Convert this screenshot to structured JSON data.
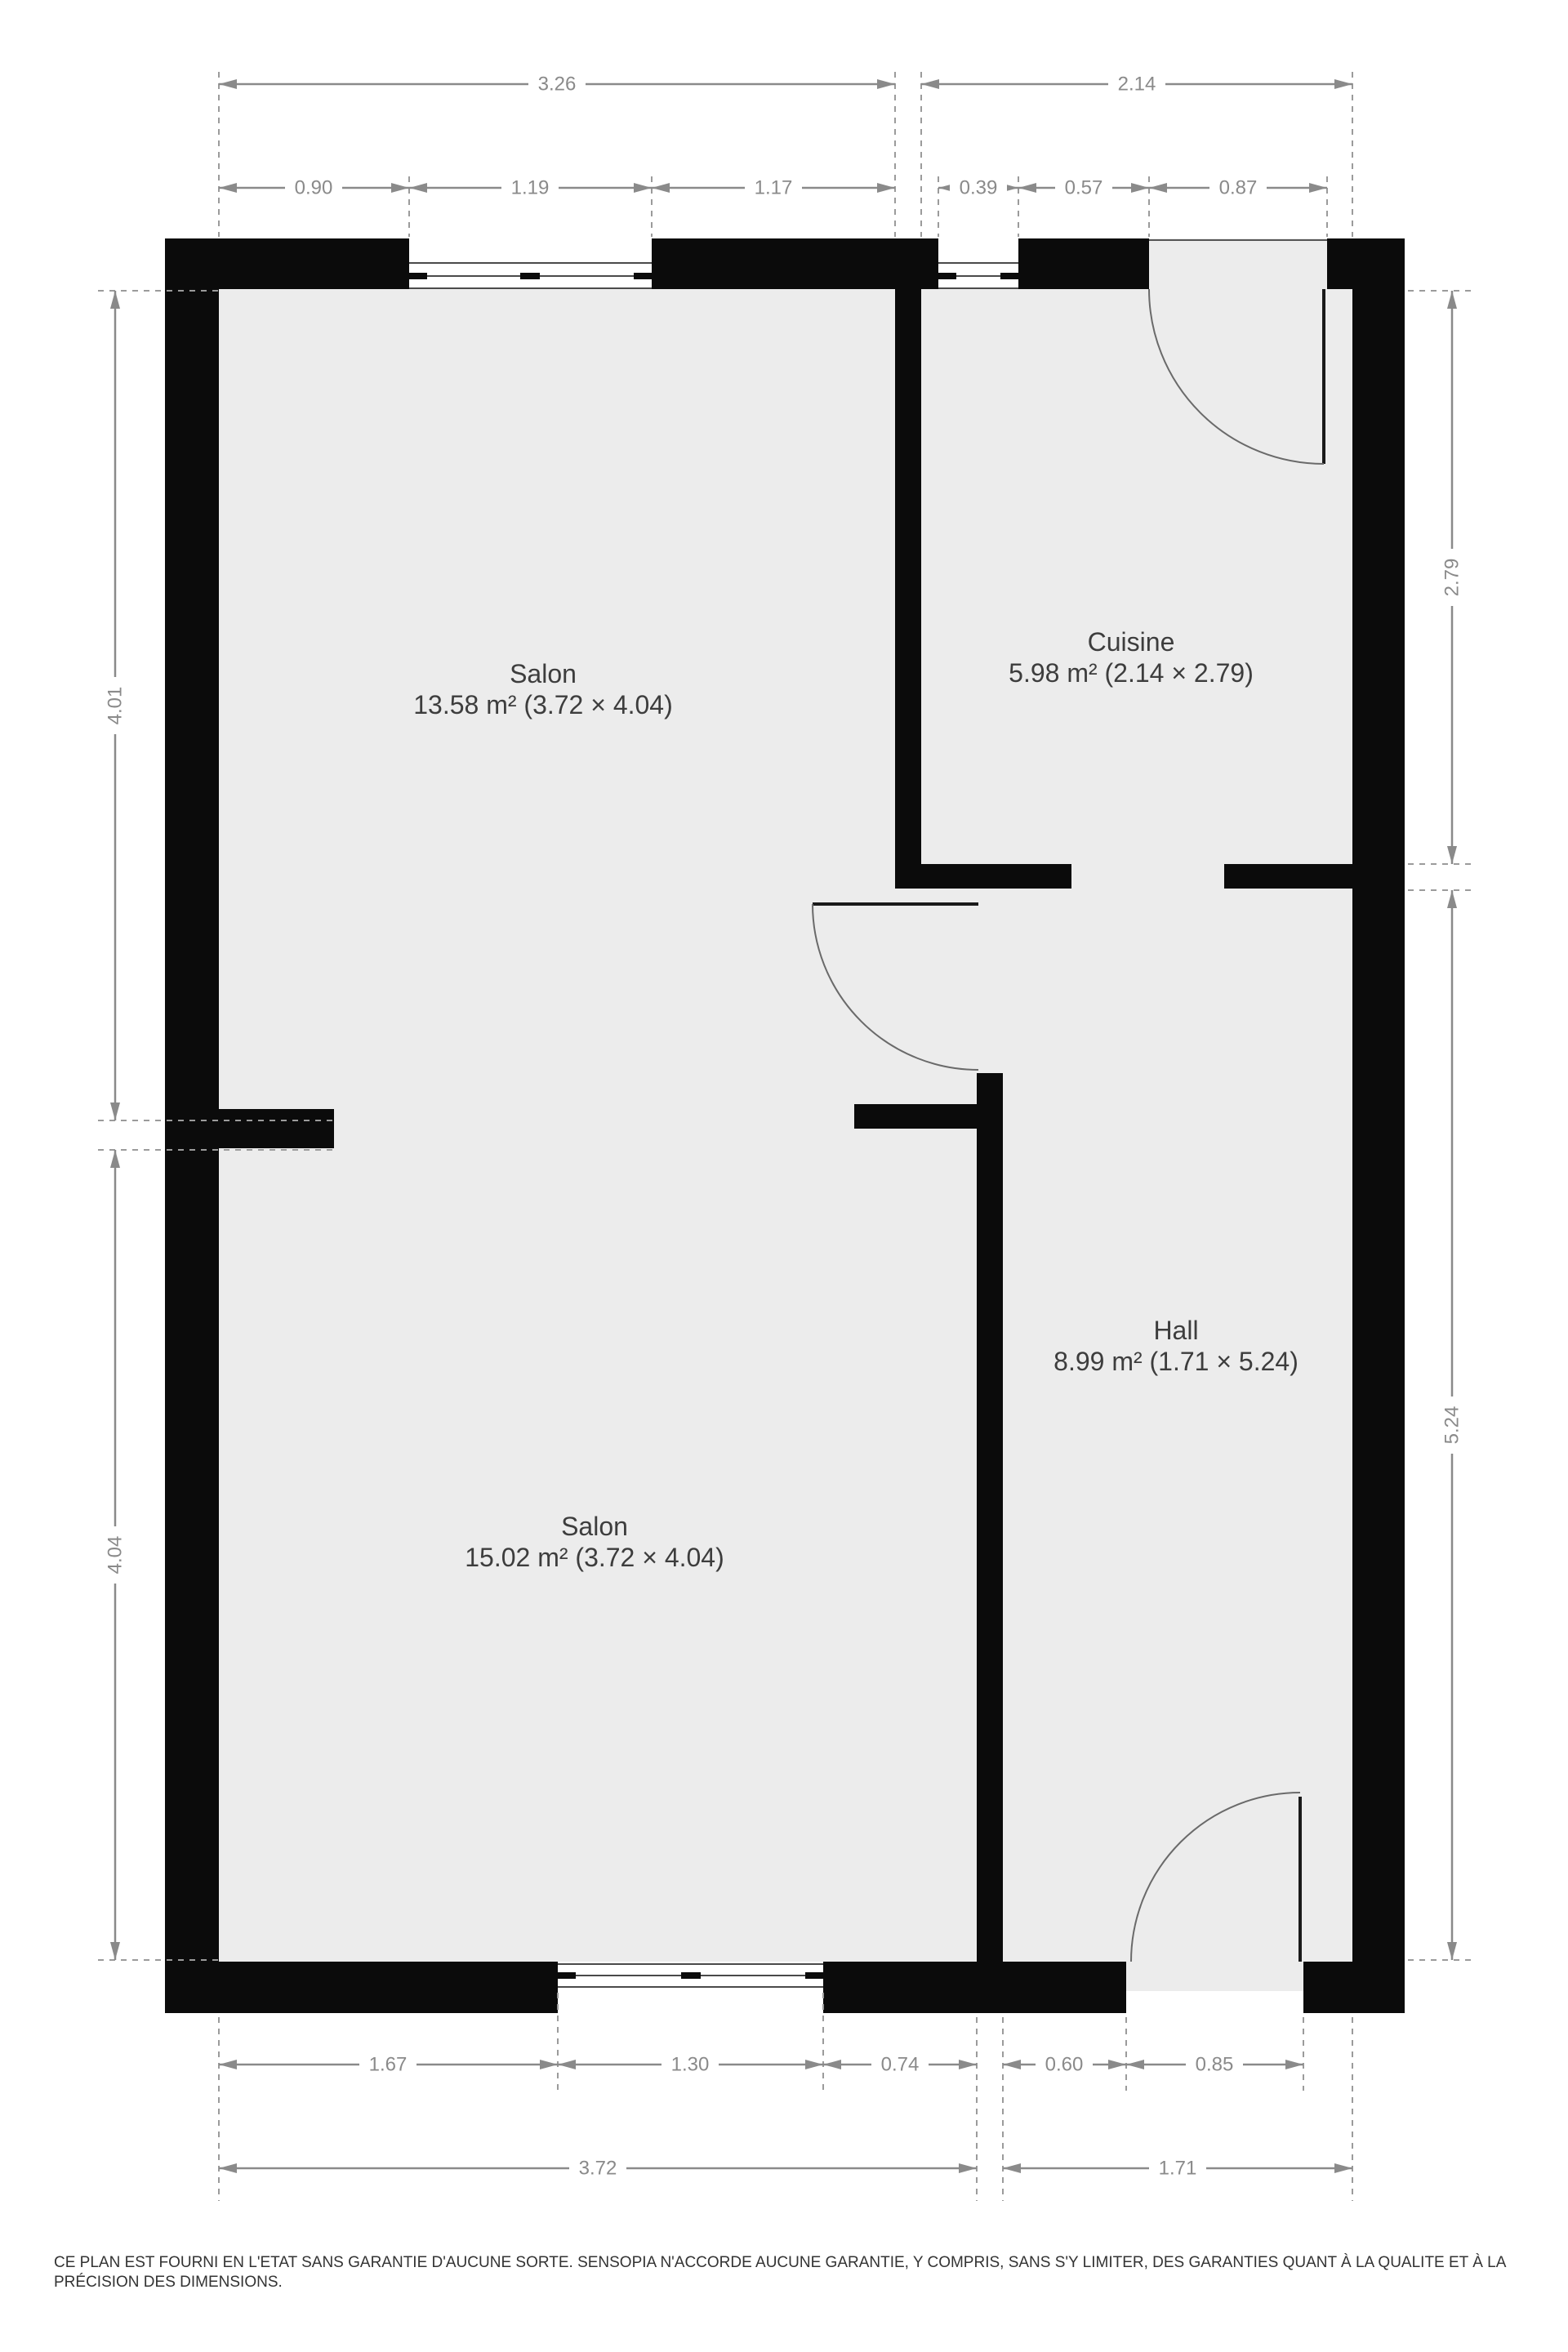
{
  "plan": {
    "type": "floor-plan",
    "colors": {
      "wall": "#0b0b0b",
      "floor": "#ececec",
      "dimension": "#8a8a8a",
      "room_label": "#3d3d3d",
      "disclaimer_text": "#333333"
    }
  },
  "rooms": [
    {
      "name": "Salon",
      "details": "13.58 m² (3.72 × 4.04)"
    },
    {
      "name": "Cuisine",
      "details": "5.98 m² (2.14 × 2.79)"
    },
    {
      "name": "Hall",
      "details": "8.99 m² (1.71 × 5.24)"
    },
    {
      "name": "Salon",
      "details": "15.02 m² (3.72 × 4.04)"
    }
  ],
  "dimensions": {
    "top_overall": [
      "3.26",
      "2.14"
    ],
    "top_detail": [
      "0.90",
      "1.19",
      "1.17",
      "0.39",
      "0.57",
      "0.87"
    ],
    "left": [
      "4.01",
      "4.04"
    ],
    "right": [
      "2.79",
      "5.24"
    ],
    "bottom_detail": [
      "1.67",
      "1.30",
      "0.74",
      "0.60",
      "0.85"
    ],
    "bottom_overall": [
      "3.72",
      "1.71"
    ]
  },
  "disclaimer": {
    "line1": "CE PLAN EST FOURNI EN L'ETAT SANS GARANTIE D'AUCUNE SORTE. SENSOPIA N'ACCORDE AUCUNE GARANTIE, Y COMPRIS, SANS S'Y LIMITER, DES GARANTIES QUANT À LA QUALITE ET À LA",
    "line2": "PRÉCISION DES DIMENSIONS."
  }
}
